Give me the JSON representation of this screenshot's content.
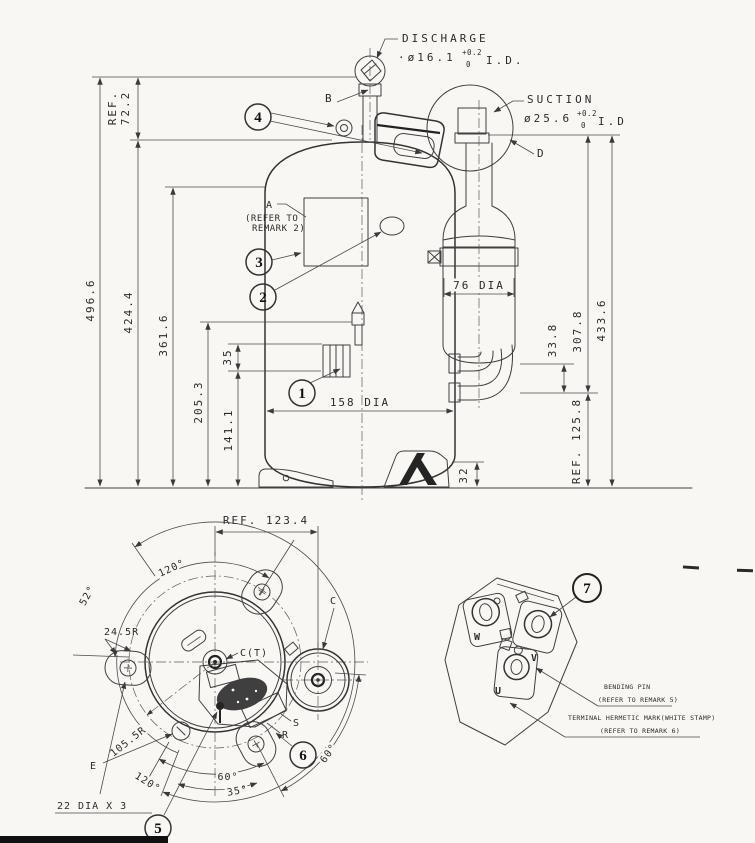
{
  "colors": {
    "ink": "#3a3a3a",
    "paper": "#f8f7f3",
    "balloon_ink": "#111111"
  },
  "main_view": {
    "discharge": {
      "title": "DISCHARGE",
      "dia": "·ø16.1",
      "tol_upper": "+0.2",
      "tol_lower": "0",
      "suffix": "I.D."
    },
    "suction": {
      "title": "SUCTION",
      "dia": "ø25.6",
      "tol_upper": "+0.2",
      "tol_lower": "0",
      "suffix": "I.D"
    },
    "callouts": {
      "a": "A",
      "a_note_1": "(REFER TO",
      "a_note_2": "REMARK 2)",
      "b": "B",
      "d": "D"
    },
    "balloons": {
      "n1": "1",
      "n2": "2",
      "n3": "3",
      "n4": "4"
    },
    "dims": {
      "ref_72_label": "REF.",
      "ref_72_value": "72.2",
      "h_496": "496.6",
      "h_424": "424.4",
      "h_361": "361.6",
      "h_205": "205.3",
      "h_141": "141.1",
      "h_35": "35",
      "w_158": "158 DIA",
      "w_76": "76 DIA",
      "r_33": "33.8",
      "r_307": "307.8",
      "r_433": "433.6",
      "r_ref125": "REF. 125.8",
      "foot_32": "32"
    }
  },
  "bottom_view": {
    "ref_123": "REF. 123.4",
    "angle_120_top": "120°",
    "angle_52": "52°",
    "angle_120_low": "120°",
    "angle_60_left": "60°",
    "angle_35": "35°",
    "angle_60_right": "60°",
    "radius_245": "24.5R",
    "radius_1055": "105.5R",
    "label_c": "C",
    "label_ct": "C(T)",
    "label_s": "S",
    "label_r": "R",
    "label_e": "E",
    "holes": "22 DIA X 3",
    "balloons": {
      "n5": "5",
      "n6": "6"
    }
  },
  "terminal_view": {
    "balloon": "7",
    "pin_w": "W",
    "pin_v": "V",
    "pin_u": "U",
    "note_bending": "BENDING PIN",
    "note_bending_ref": "(REFER TO REMARK 5)",
    "note_hermetic": "TERMINAL HERMETIC MARK(WHITE STAMP)",
    "note_hermetic_ref": "(REFER TO REMARK 6)"
  }
}
